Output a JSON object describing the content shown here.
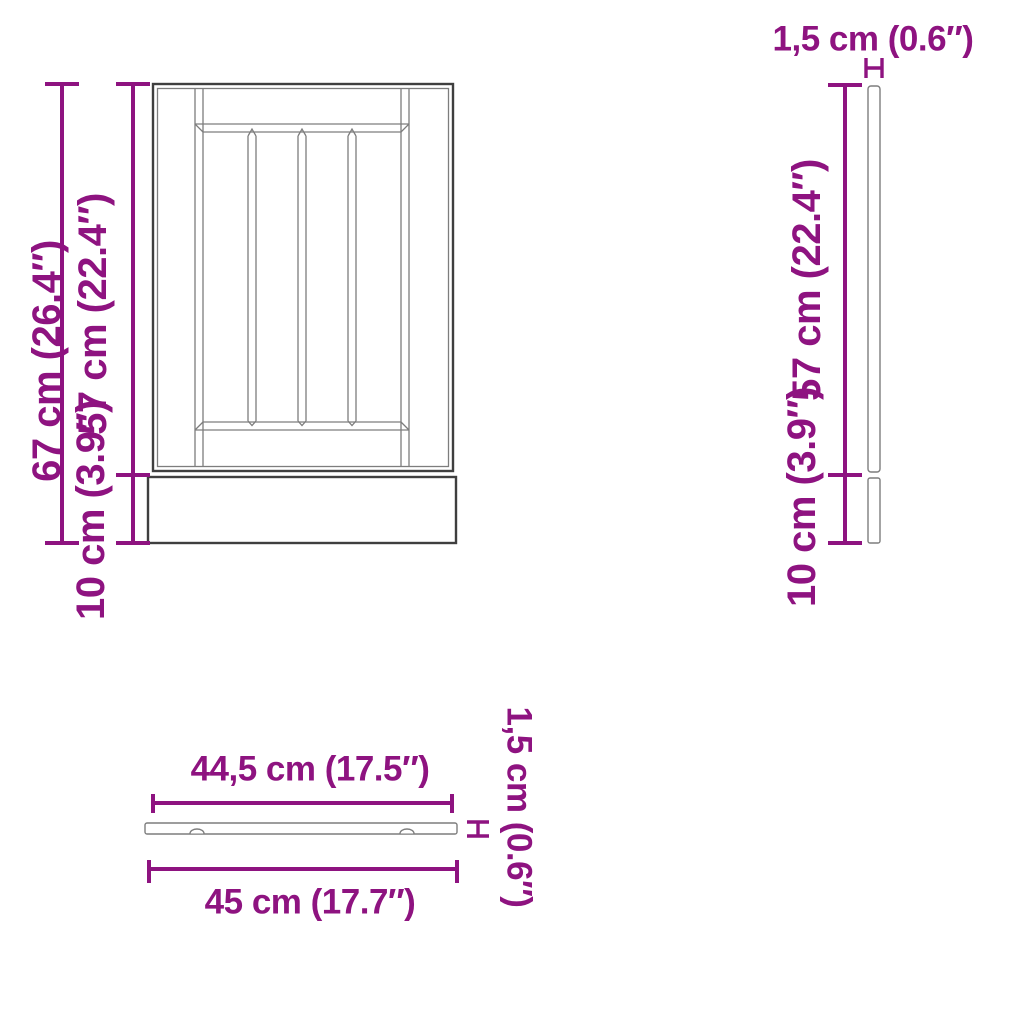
{
  "diagram_title": "cabinet panel dimension diagram",
  "colors": {
    "dimension_accent": "#8E1380",
    "drawing_outline_dark": "#3F3F3F",
    "drawing_outline_light": "#7D7D7D",
    "background": "#FFFFFF"
  },
  "front_view": {
    "total_height": "67 cm (26.4″)",
    "door_height": "57 cm (22.4″)",
    "plinth_height": "10 cm (3.9″)"
  },
  "side_view": {
    "thickness": "1,5 cm (0.6″)",
    "door_height": "57 cm (22.4″)",
    "plinth_height": "10 cm (3.9″)"
  },
  "top_view": {
    "panel_width": "44,5 cm (17.5″)",
    "total_width": "45 cm (17.7″)",
    "thickness": "1,5 cm (0.6″)"
  }
}
